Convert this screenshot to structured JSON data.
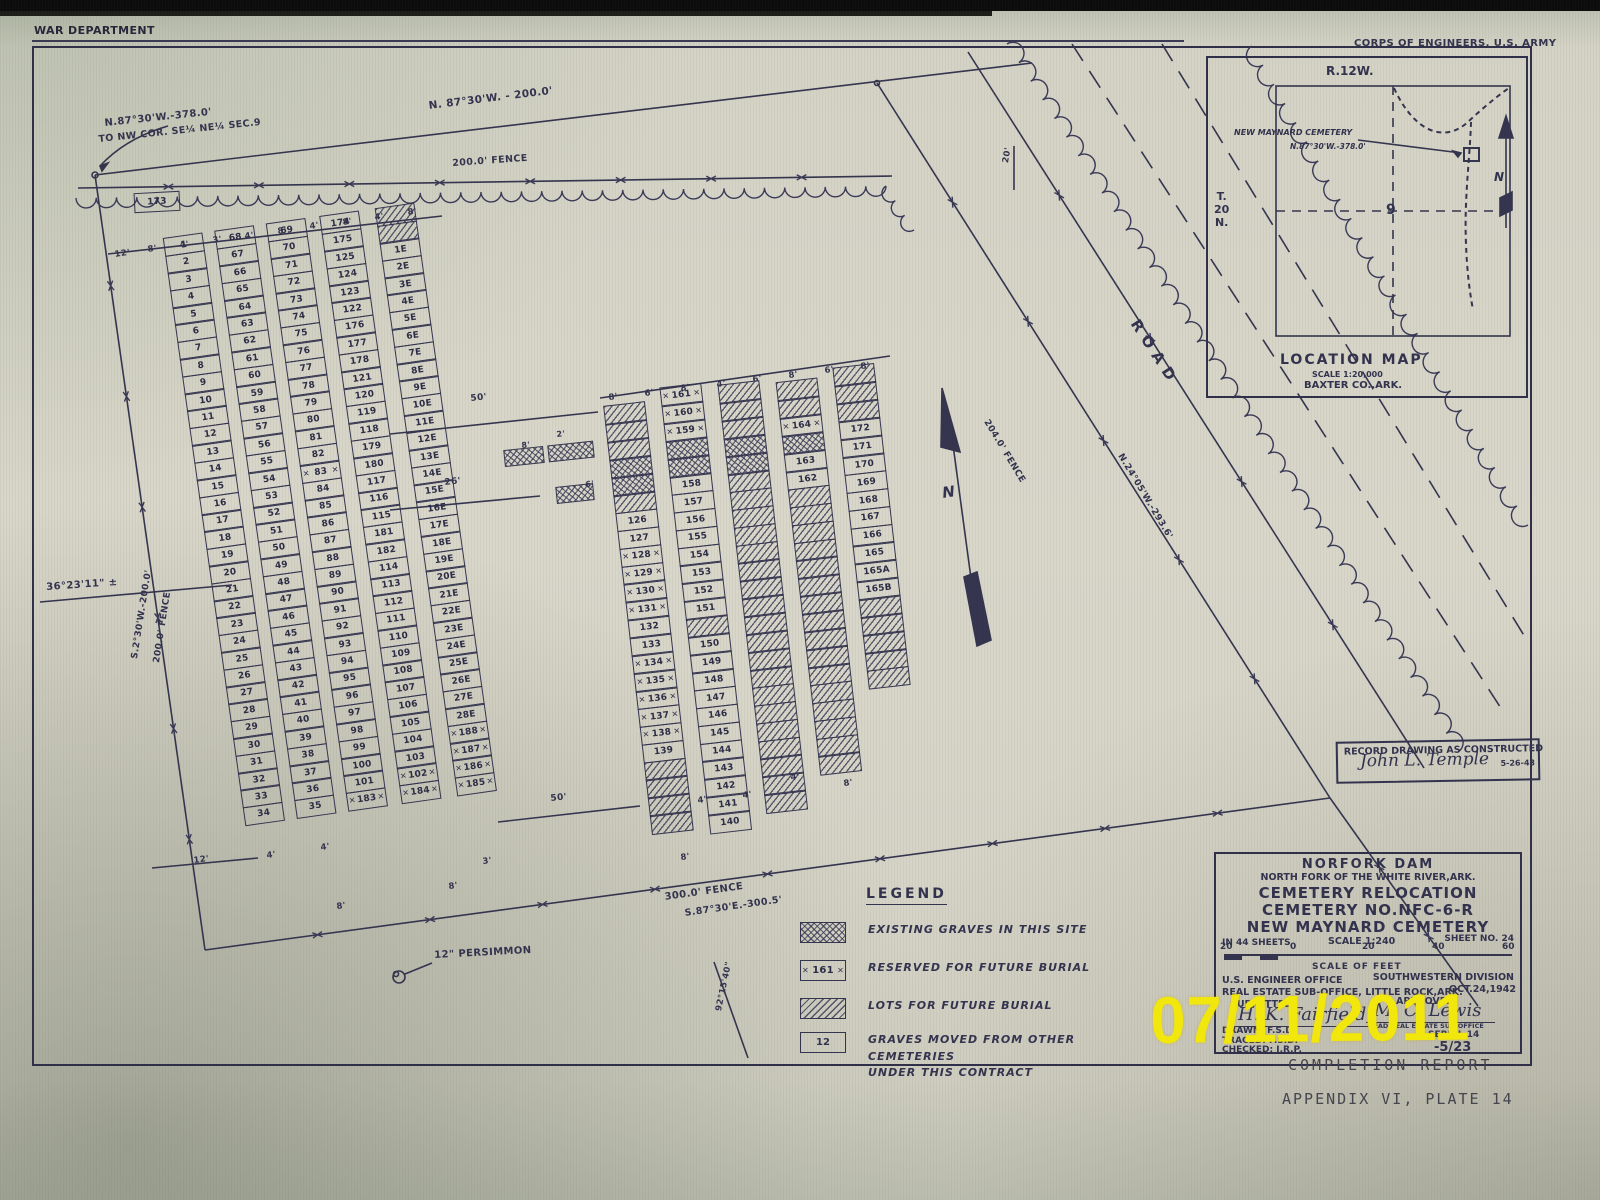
{
  "header": {
    "top_left": "WAR DEPARTMENT",
    "top_right": "CORPS OF ENGINEERS, U.S. ARMY"
  },
  "plat": {
    "nw_note1": "N.87°30'W.-378.0'",
    "nw_note2": "TO NW COR. SE¼ NE¼ SEC.9",
    "n_bearing": "N. 87°30'W. - 200.0'",
    "n_fence": "200.0' FENCE",
    "w_angle": "36°23'11\" ±",
    "w_bearing": "S.2°30'W.-200.0'",
    "w_fence": "200.0' FENCE",
    "s_fence": "300.0' FENCE",
    "s_bearing": "S.87°30'E.-300.5'",
    "s_angle": "92°15'40\"",
    "e_fence": "204.0' FENCE",
    "e_bearing": "N.24°05'W.-293.6'",
    "road": "ROAD",
    "persimmon": "12\" PERSIMMON",
    "north_letter": "N"
  },
  "dims": {
    "d20": "20'",
    "d50a": "50'",
    "d26": "26'",
    "d50b": "50'",
    "d8": "8'",
    "d2": "2'",
    "d6": "6'",
    "block1_top": [
      "12'",
      "8'",
      "4'",
      "3'",
      "4'",
      "8'",
      "4'",
      "8'",
      "4'",
      "8'"
    ],
    "block1_bottom": [
      "12'",
      "4'",
      "4'",
      "8'",
      "8'",
      "3'"
    ],
    "block2_top": [
      "8'",
      "6'",
      "8'",
      "4'",
      "6'",
      "8'",
      "6'",
      "8'"
    ],
    "block2_bottom": [
      "4'",
      "4'",
      "4'",
      "8'",
      "8'"
    ]
  },
  "graves": {
    "plot173": "173",
    "block1": {
      "c1": [
        "1",
        "2",
        "3",
        "4",
        "5",
        "6",
        "7",
        "8",
        "9",
        "10",
        "11",
        "12",
        "13",
        "14",
        "15",
        "16",
        "17",
        "18",
        "19",
        "20",
        "21",
        "22",
        "23",
        "24",
        "25",
        "26",
        "27",
        "28",
        "29",
        "30",
        "31",
        "32",
        "33",
        "34"
      ],
      "c2": [
        "68",
        "67",
        "66",
        "65",
        "64",
        "63",
        "62",
        "61",
        "60",
        "59",
        "58",
        "57",
        "56",
        "55",
        "54",
        "53",
        "52",
        "51",
        "50",
        "49",
        "48",
        "47",
        "46",
        "45",
        "44",
        "43",
        "42",
        "41",
        "40",
        "39",
        "38",
        "37",
        "36",
        "35"
      ],
      "c3": [
        "69",
        "70",
        "71",
        "72",
        "73",
        "74",
        "75",
        "76",
        "77",
        "78",
        "79",
        "80",
        "81",
        "82",
        "r:83",
        "84",
        "85",
        "86",
        "87",
        "88",
        "89",
        "90",
        "91",
        "92",
        "93",
        "94",
        "95",
        "96",
        "97",
        "98",
        "99",
        "100",
        "101",
        "r:183"
      ],
      "c4": [
        "174",
        "175",
        "125",
        "124",
        "123",
        "122",
        "176",
        "177",
        "178",
        "121",
        "120",
        "119",
        "118",
        "179",
        "180",
        "117",
        "116",
        "115",
        "181",
        "182",
        "114",
        "113",
        "112",
        "111",
        "110",
        "109",
        "108",
        "107",
        "106",
        "105",
        "104",
        "103",
        "r:102",
        "r:184"
      ],
      "c5": [
        "h",
        "h",
        "1E",
        "2E",
        "3E",
        "4E",
        "5E",
        "6E",
        "7E",
        "8E",
        "9E",
        "10E",
        "11E",
        "12E",
        "13E",
        "14E",
        "15E",
        "16E",
        "17E",
        "18E",
        "19E",
        "20E",
        "21E",
        "22E",
        "23E",
        "24E",
        "25E",
        "26E",
        "27E",
        "28E",
        "r:188",
        "r:187",
        "r:186",
        "r:185"
      ]
    },
    "block2": {
      "cA": [
        "h",
        "h",
        "h",
        "x",
        "x",
        "h",
        "126",
        "127",
        "r:128",
        "r:129",
        "r:130",
        "r:131",
        "132",
        "133",
        "r:134",
        "r:135",
        "r:136",
        "r:137",
        "r:138",
        "139",
        "h",
        "h",
        "h",
        "h"
      ],
      "cB": [
        "r:161",
        "r:160",
        "r:159",
        "x",
        "x",
        "158",
        "157",
        "156",
        "155",
        "154",
        "153",
        "152",
        "151",
        "h",
        "150",
        "149",
        "148",
        "147",
        "146",
        "145",
        "144",
        "143",
        "142",
        "141",
        "140"
      ],
      "cC": [
        "h",
        "h",
        "h",
        "x",
        "x",
        "h",
        "h",
        "h",
        "h",
        "h",
        "h",
        "h",
        "h",
        "h",
        "h",
        "h",
        "h",
        "h",
        "h",
        "h",
        "h",
        "h",
        "h",
        "h"
      ],
      "cD": [
        "h",
        "h",
        "r:164",
        "x",
        "163",
        "162",
        "h",
        "h",
        "h",
        "h",
        "h",
        "h",
        "h",
        "h",
        "h",
        "h",
        "h",
        "h",
        "h",
        "h",
        "h",
        "h"
      ],
      "cE": [
        "h",
        "h",
        "h",
        "172",
        "171",
        "170",
        "169",
        "168",
        "167",
        "166",
        "165",
        "165A",
        "165B",
        "h",
        "h",
        "h",
        "h",
        "h"
      ]
    }
  },
  "legend": {
    "title": "LEGEND",
    "items": [
      {
        "symbol": "existing-graves-swatch",
        "sample": "",
        "label": "EXISTING GRAVES IN THIS SITE",
        "label2": ""
      },
      {
        "symbol": "reserved-swatch",
        "sample": "161",
        "label": "RESERVED FOR FUTURE BURIAL",
        "label2": ""
      },
      {
        "symbol": "future-lots-swatch",
        "sample": "",
        "label": "LOTS FOR FUTURE BURIAL",
        "label2": ""
      },
      {
        "symbol": "moved-graves-swatch",
        "sample": "12",
        "label": "GRAVES MOVED FROM OTHER CEMETERIES",
        "label2": "UNDER THIS CONTRACT"
      }
    ]
  },
  "location_map": {
    "range": "R.12W.",
    "township_lines": [
      "T.",
      "20",
      "N."
    ],
    "section": "9",
    "cemetery_label": "NEW MAYNARD CEMETERY",
    "bearing": "N.87°30'W.-378.0'",
    "north_letter": "N",
    "title": "LOCATION MAP",
    "scale": "SCALE 1:20,000",
    "county": "BAXTER CO.,ARK."
  },
  "record_stamp": {
    "line": "RECORD DRAWING AS CONSTRUCTED",
    "signature": "John L. Temple",
    "date": "5-26-43"
  },
  "title_block": {
    "line1": "NORFORK DAM",
    "line2": "NORTH FORK OF THE WHITE RIVER,ARK.",
    "line3": "CEMETERY RELOCATION",
    "line4": "CEMETERY NO.NFC-6-R",
    "line5": "NEW MAYNARD CEMETERY",
    "sheets": "IN 44 SHEETS",
    "scale": "SCALE 1:240",
    "sheet_no": "SHEET NO. 24",
    "scale_ticks": [
      "20",
      "0",
      "20",
      "40",
      "60"
    ],
    "scale_of_feet": "SCALE OF FEET",
    "office1": "U.S. ENGINEER OFFICE",
    "office2": "REAL ESTATE SUB-OFFICE,  LITTLE ROCK,ARK.",
    "division": "SOUTHWESTERN DIVISION",
    "date": "OCT.24,1942",
    "submitted": "SUBMITTED:",
    "approved": "APPROVED:",
    "sig_left": "H. K. Fairfield",
    "sig_right": "M. C. Lewis",
    "sig_right_title": "HEAD REAL ESTATE SUB-OFFICE",
    "drawn": "DRAWN:  F.S.D.",
    "traced": "TRACED: F.S.D.",
    "checked": "CHECKED: J.R.P.",
    "serial": "SERIAL 14",
    "file_no": "-5/23"
  },
  "stamps": {
    "date": "07/11/2011",
    "completion": "COMPLETION REPORT",
    "appendix": "APPENDIX VI, PLATE 14"
  }
}
